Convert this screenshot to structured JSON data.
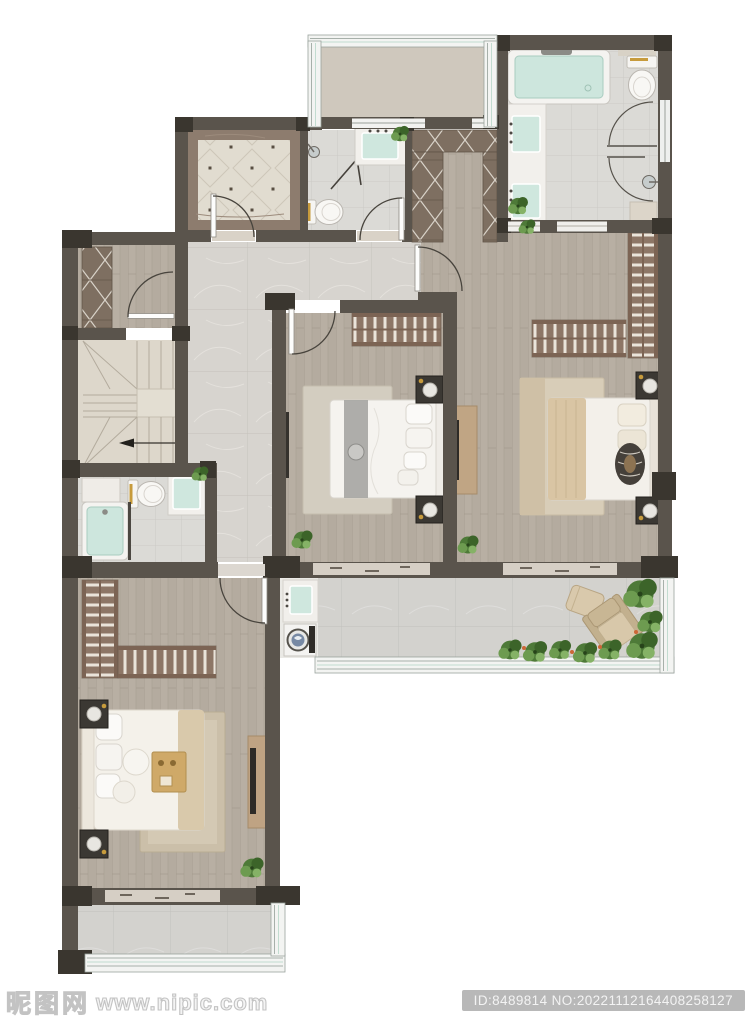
{
  "watermark": {
    "site_name": "昵图网",
    "site_url": "www.nipic.com",
    "image_id_text": "ID:8489814 NO:20221112164408258127"
  },
  "floor_plan": {
    "type": "residential upper-floor plan, top-down 3D render, no text labels",
    "rooms": [
      {
        "id": "bay-window",
        "label": "bay window at top"
      },
      {
        "id": "foyer",
        "label": "entry foyer with decorative diagonal tile and door"
      },
      {
        "id": "guest-bathroom-upper",
        "label": "bathroom with shower, folding door, toilet, mint sink vanity, plant"
      },
      {
        "id": "walk-in-closet",
        "label": "U-shaped walk-in closet with cross-hatch wardrobes"
      },
      {
        "id": "master-bathroom",
        "label": "master bathroom with bathtub, double mint sinks, toilet, glass shower"
      },
      {
        "id": "cloak-room",
        "label": "small cloak room with cross-hatch wardrobe and door"
      },
      {
        "id": "staircase",
        "label": "U-shaped staircase with direction arrow"
      },
      {
        "id": "hallway",
        "label": "L-shaped marble hallway"
      },
      {
        "id": "bathroom-lower",
        "label": "bathroom with mint bathtub, toilet, vanity, cabinet"
      },
      {
        "id": "bedroom-middle",
        "label": "bedroom: slatted wardrobe, double bed with gray runner, nightstands, wall TV, rug, plant"
      },
      {
        "id": "bedroom-right",
        "label": "bedroom: L-shaped slatted wardrobe, double bed with tan blanket, nightstands, TV console, rug, plant"
      },
      {
        "id": "master-bedroom",
        "label": "master bedroom: L-shaped wardrobe, bed with breakfast tray, nightstands, TV console, rug, plant"
      },
      {
        "id": "laundry",
        "label": "laundry nook with mint sink and washing machine"
      },
      {
        "id": "terrace",
        "label": "tiled terrace with lounge chair, ottoman and planting"
      },
      {
        "id": "balcony",
        "label": "tiled balcony below master bedroom"
      }
    ],
    "colors": {
      "wall": "#5a544c",
      "wall_dark": "#3a362f",
      "wood_floor": "#b8afa3",
      "marble_floor": "#d7d4cf",
      "tile_floor": "#dbdad6",
      "stair": "#ddd7cb",
      "wardrobe": "#8d7666",
      "mint_fixture": "#cde6dd",
      "gold_accent": "#c79b3c",
      "plant": "#4e7a38",
      "watermark_gray": "#c3c3c3",
      "badge_gray": "#b8b8b8"
    }
  }
}
